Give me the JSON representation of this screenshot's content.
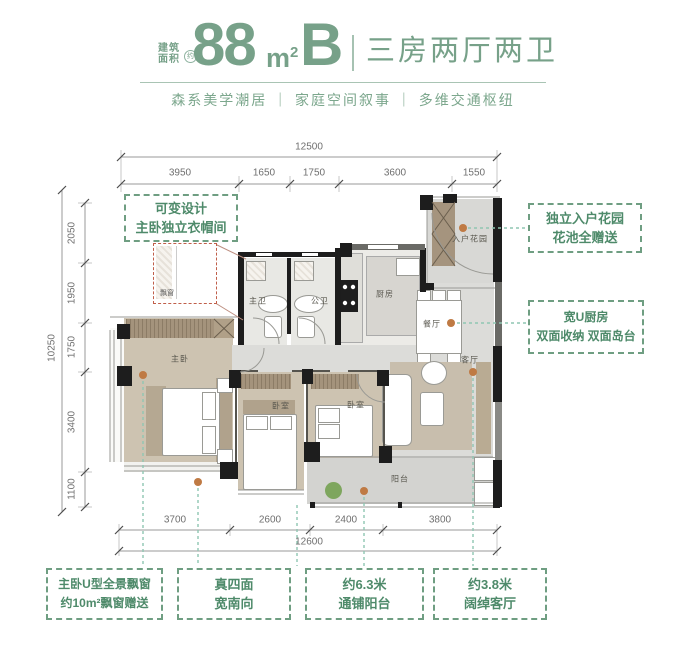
{
  "header": {
    "area_label_line1": "建筑",
    "area_label_line2": "面积",
    "area_approx": "约",
    "area_value": "88",
    "area_unit": "m",
    "area_unit_sup": "2",
    "type_letter": "B",
    "subtitle": "三房两厅两卫",
    "tagline": "森系美学潮居 ｜ 家庭空间叙事 ｜ 多维交通枢纽"
  },
  "callouts": {
    "variable": {
      "line1": "可变设计",
      "line2": "主卧独立衣帽间"
    },
    "garden": {
      "line1": "独立入户花园",
      "line2": "花池全赠送"
    },
    "kitchen": {
      "line1": "宽U厨房",
      "line2": "双面收纳 双面岛台"
    },
    "bay": {
      "line1": "主卧U型全景飘窗",
      "line2": "约10m²飘窗赠送"
    },
    "south": {
      "line1": "真四面",
      "line2": "宽南向"
    },
    "balcony": {
      "line1": "约6.3米",
      "line2": "通铺阳台"
    },
    "living": {
      "line1": "约3.8米",
      "line2": "阔绰客厅"
    }
  },
  "plan": {
    "rooms": {
      "master": "主卧",
      "bed2": "卧室",
      "bed3": "卧室",
      "bath_master": "主卫",
      "bath_public": "公卫",
      "kitchen": "厨房",
      "entry_garden": "入户花园",
      "dining": "餐厅",
      "living": "客厅",
      "balcony": "阳台",
      "bay_inset": "飘窗"
    }
  },
  "dims": {
    "top": {
      "total": "12500",
      "segments": [
        "3950",
        "1650",
        "1750",
        "3600",
        "1550"
      ]
    },
    "left": {
      "total": "10250",
      "segments": [
        "2050",
        "1950",
        "1750",
        "3400",
        "1100"
      ]
    },
    "bottom": {
      "total": "12600",
      "segments": [
        "3700",
        "2600",
        "2400",
        "3800"
      ]
    }
  },
  "colors": {
    "brand_green": "#77A189",
    "callout_green": "#4E8A6A",
    "leader_teal": "#8FC6B2",
    "anchor_orange": "#BF7A44",
    "wall_black": "#1D1D1D",
    "wood_floor": "#CDC3B1",
    "inset_red": "#C05F4A"
  }
}
